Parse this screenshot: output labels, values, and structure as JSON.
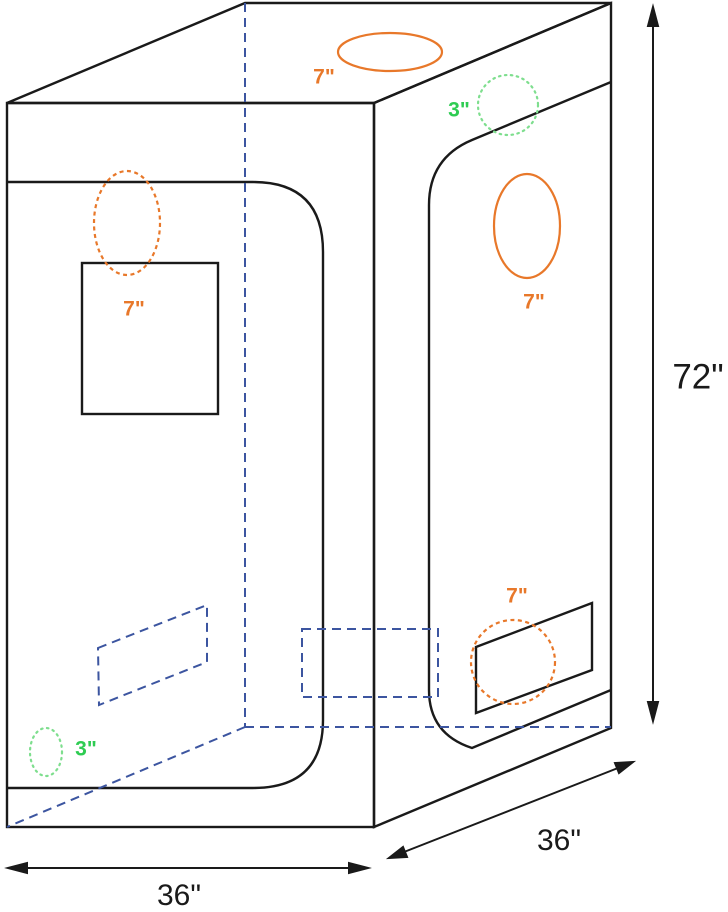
{
  "diagram": {
    "dimensions": {
      "height": "72\"",
      "width": "36\"",
      "depth": "36\""
    },
    "vents": {
      "top": "7\"",
      "right_top_small": "3\"",
      "right_upper": "7\"",
      "right_lower": "7\"",
      "front_upper": "7\"",
      "front_lower_small": "3\""
    },
    "colors": {
      "line_black": "#1a1a1a",
      "hidden_edge_blue": "#3C55A0",
      "vent_orange": "#E8782A",
      "vent_green_label": "#2ECC52",
      "vent_green_stroke": "#7EDE8E"
    }
  }
}
